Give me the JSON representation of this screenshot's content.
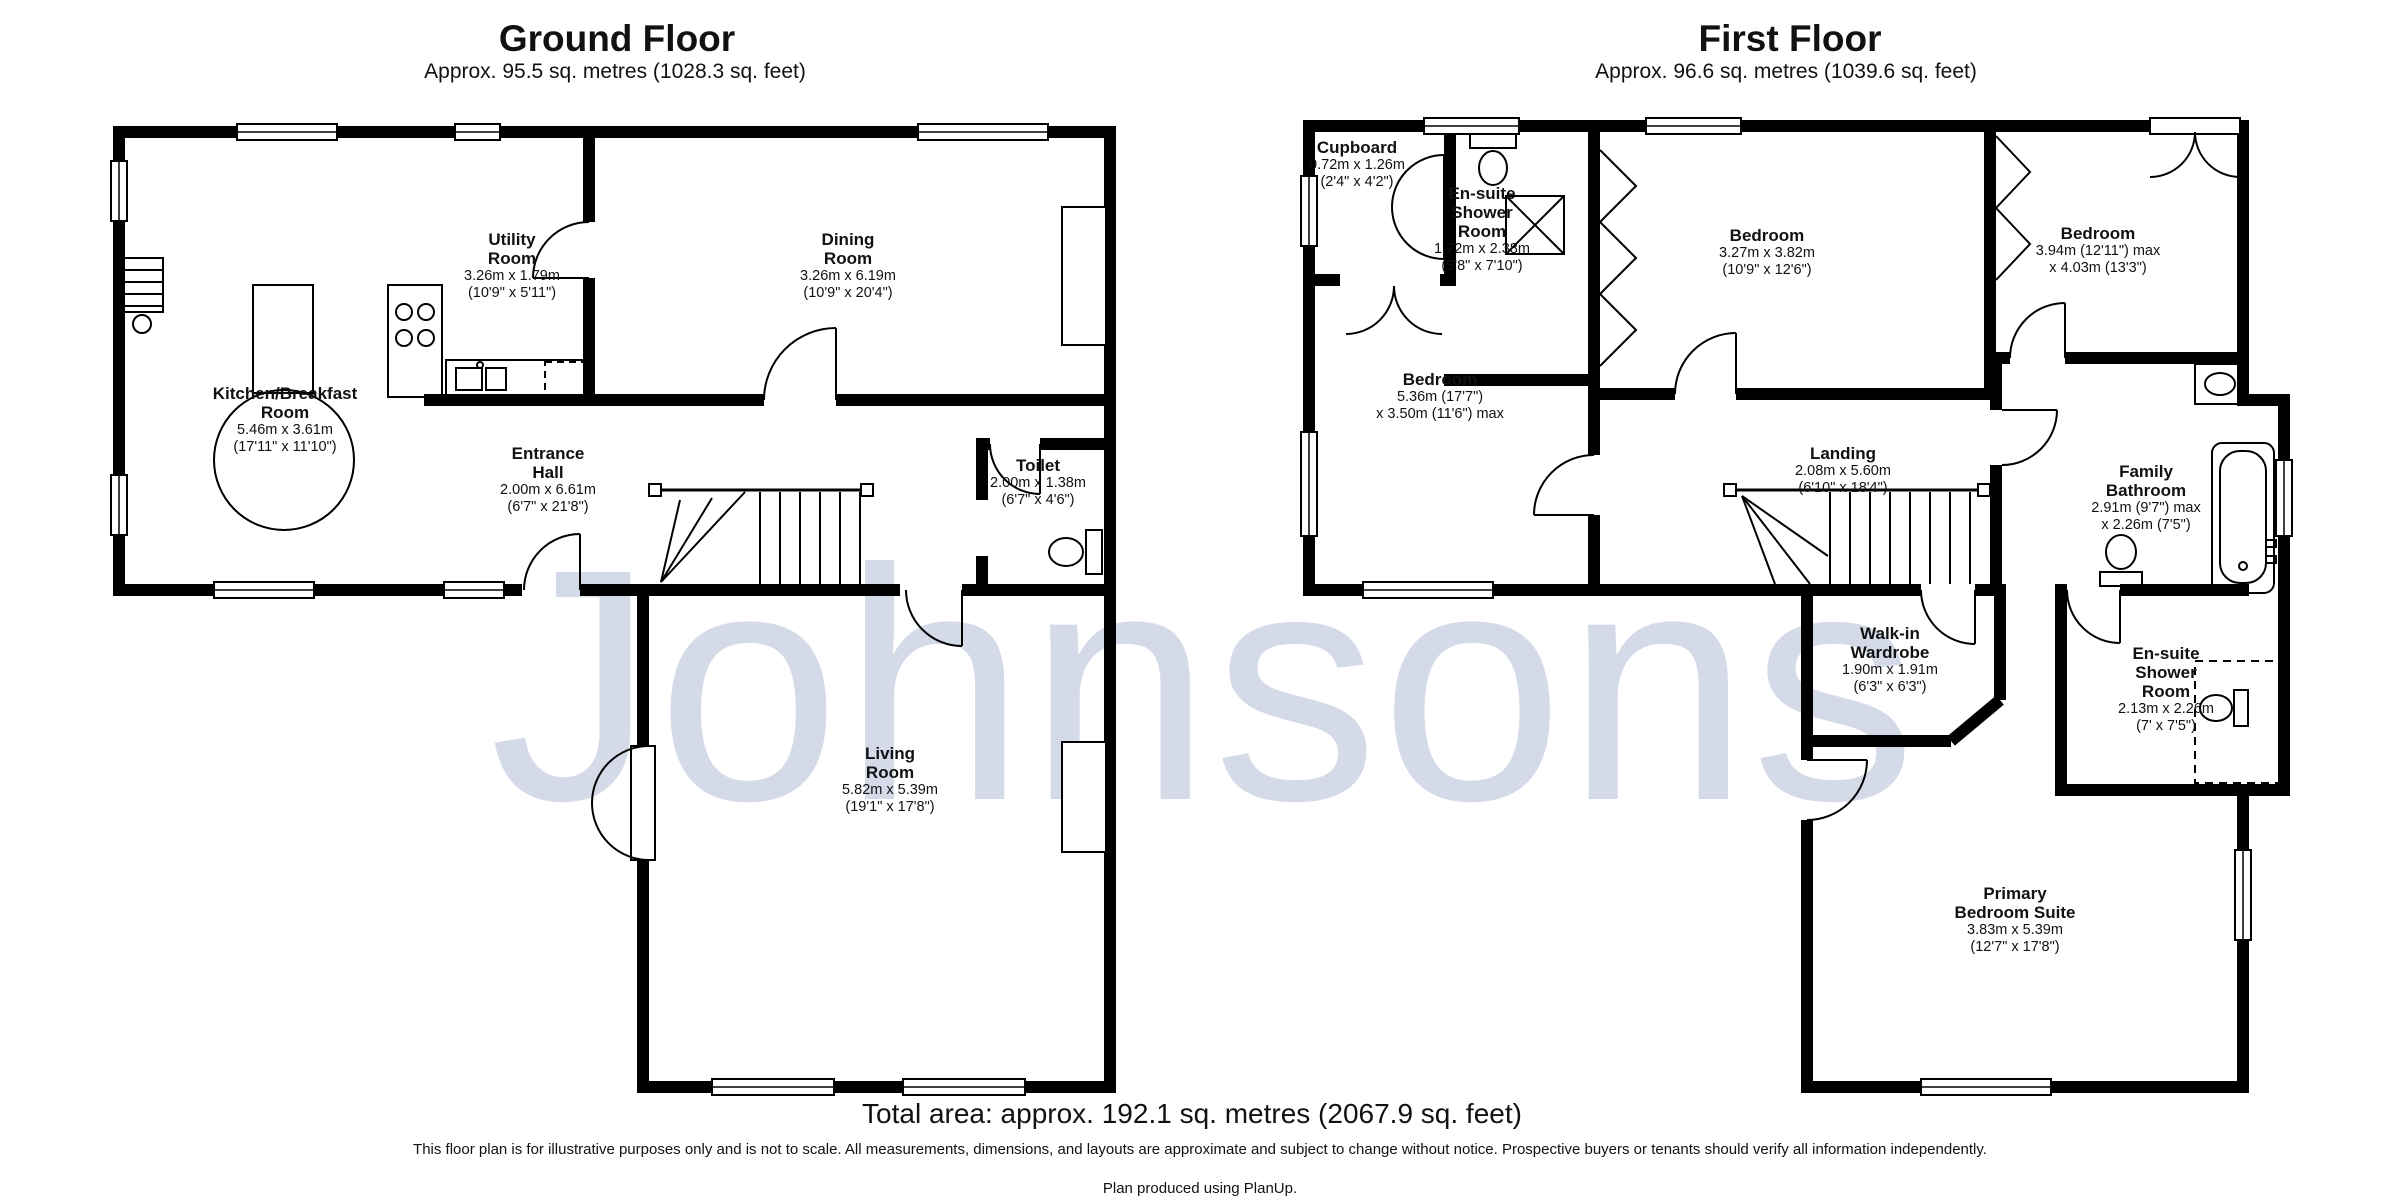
{
  "watermark": "Johnsons",
  "floors": [
    {
      "title": "Ground Floor",
      "subtitle": "Approx. 95.5 sq. metres (1028.3 sq. feet)",
      "rooms": [
        {
          "name": "Kitchen/Breakfast\nRoom",
          "dims": "5.46m x 3.61m\n(17'11\" x 11'10\")"
        },
        {
          "name": "Utility\nRoom",
          "dims": "3.26m x 1.79m\n(10'9\" x 5'11\")"
        },
        {
          "name": "Dining\nRoom",
          "dims": "3.26m x 6.19m\n(10'9\" x 20'4\")"
        },
        {
          "name": "Entrance\nHall",
          "dims": "2.00m x 6.61m\n(6'7\" x 21'8\")"
        },
        {
          "name": "Toilet",
          "dims": "2.00m x 1.38m\n(6'7\" x 4'6\")"
        },
        {
          "name": "Living\nRoom",
          "dims": "5.82m x 5.39m\n(19'1\" x 17'8\")"
        }
      ]
    },
    {
      "title": "First Floor",
      "subtitle": "Approx. 96.6 sq. metres (1039.6 sq. feet)",
      "rooms": [
        {
          "name": "Cupboard",
          "dims": "0.72m x 1.26m\n(2'4\" x 4'2\")"
        },
        {
          "name": "En-suite\nShower\nRoom",
          "dims": "1.72m x 2.38m\n(5'8\" x 7'10\")"
        },
        {
          "name": "Bedroom",
          "dims": "5.36m (17'7\")\nx 3.50m (11'6\") max"
        },
        {
          "name": "Bedroom",
          "dims": "3.27m x 3.82m\n(10'9\" x 12'6\")"
        },
        {
          "name": "Bedroom",
          "dims": "3.94m (12'11\") max\nx 4.03m (13'3\")"
        },
        {
          "name": "Landing",
          "dims": "2.08m x 5.60m\n(6'10\" x 18'4\")"
        },
        {
          "name": "Family\nBathroom",
          "dims": "2.91m (9'7\") max\nx 2.26m (7'5\")"
        },
        {
          "name": "Walk-in\nWardrobe",
          "dims": "1.90m x 1.91m\n(6'3\" x 6'3\")"
        },
        {
          "name": "En-suite\nShower\nRoom",
          "dims": "2.13m x 2.26m\n(7' x 7'5\")"
        },
        {
          "name": "Primary\nBedroom Suite",
          "dims": "3.83m x 5.39m\n(12'7\" x 17'8\")"
        }
      ]
    }
  ],
  "footer": {
    "total_area": "Total area: approx. 192.1 sq. metres (2067.9 sq. feet)",
    "disclaimer": "This floor plan is for illustrative purposes only and is not to scale. All measurements, dimensions, and layouts are approximate and subject to change without notice. Prospective buyers or tenants should verify all information independently.",
    "credit": "Plan produced using PlanUp."
  }
}
